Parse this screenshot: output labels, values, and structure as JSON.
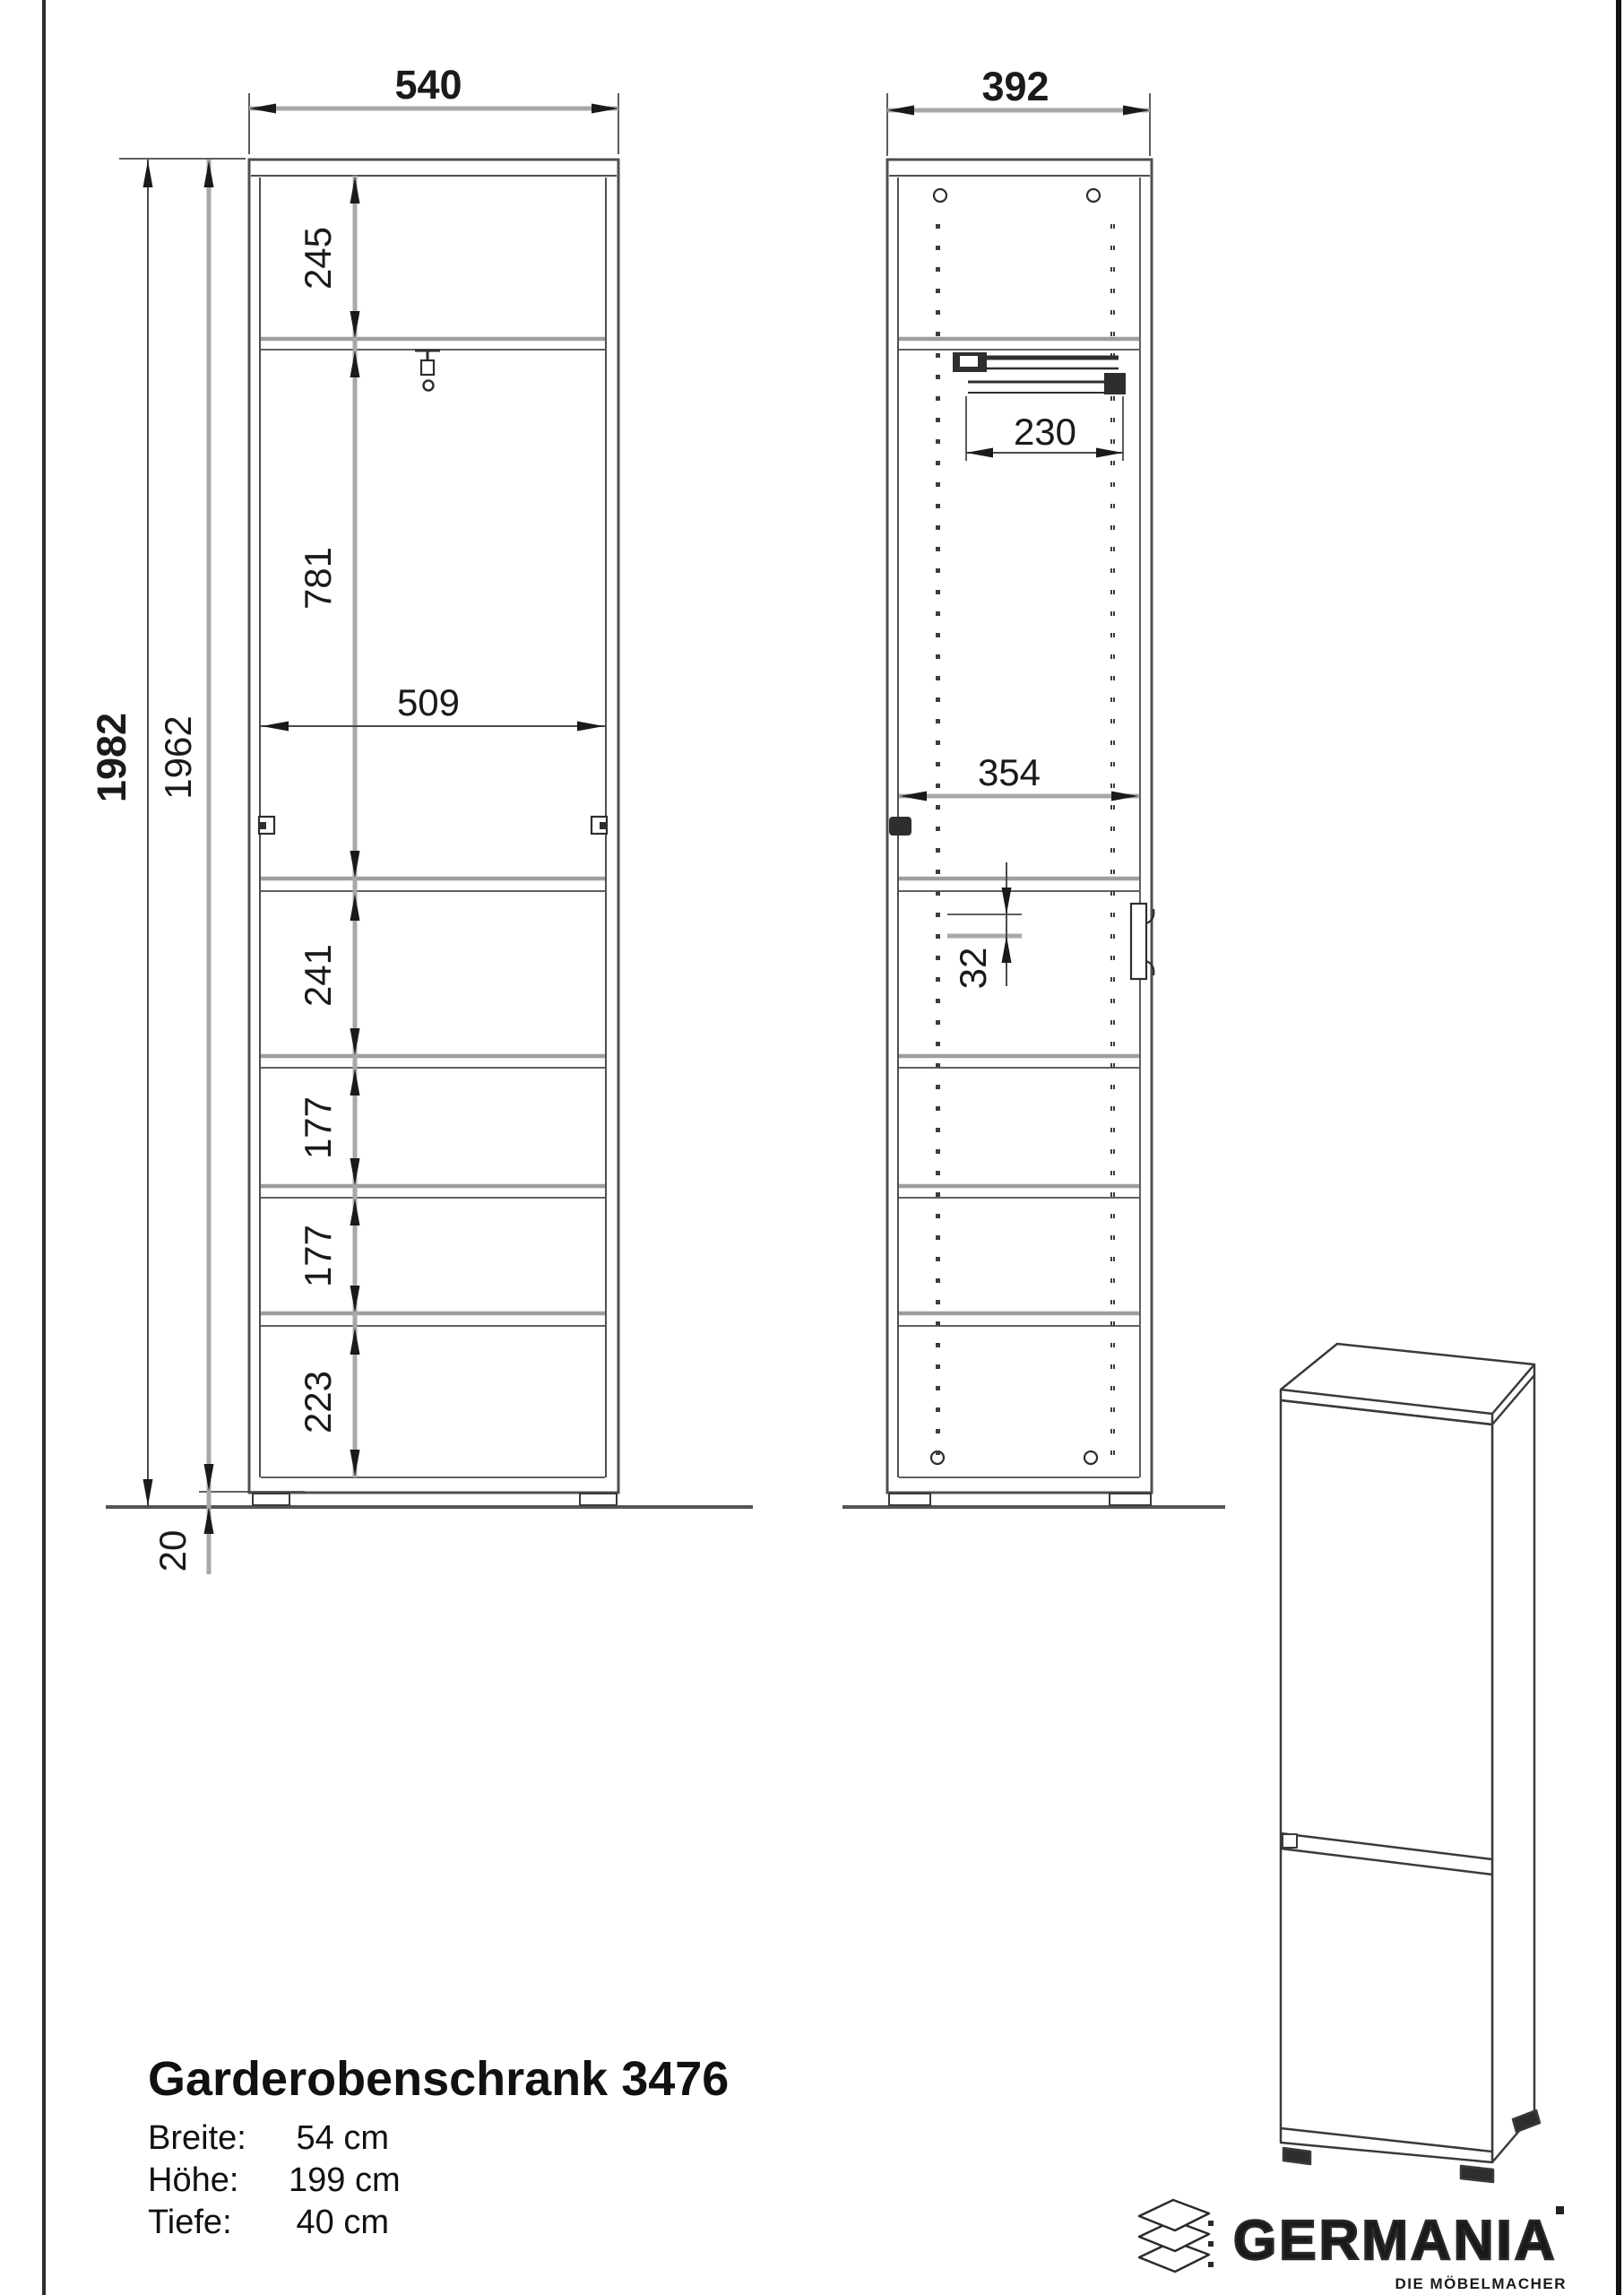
{
  "drawing": {
    "front_view": {
      "width": "540",
      "total_height": "1982",
      "body_height": "1962",
      "plinth_height": "20",
      "top_compartment": "245",
      "wardrobe_compartment": "781",
      "inner_width": "509",
      "compartments": [
        "241",
        "177",
        "177",
        "223"
      ]
    },
    "side_view": {
      "depth": "392",
      "rail_depth": "230",
      "inner_depth": "354",
      "hole_pitch": "32"
    }
  },
  "product": {
    "title": "Garderobenschrank 3476",
    "specs": [
      {
        "label": "Breite:",
        "value": "54 cm"
      },
      {
        "label": "Höhe:",
        "value": "199 cm"
      },
      {
        "label": "Tiefe:",
        "value": "40 cm"
      }
    ]
  },
  "brand": {
    "name": "GERMANIA",
    "tagline": "DIE MÖBELMACHER"
  },
  "colors": {
    "outline": "#4f4f4f",
    "dim_gray": "#a8a8a8",
    "arrow": "#1a1a1a",
    "shelf_gray": "#9e9e9e"
  }
}
